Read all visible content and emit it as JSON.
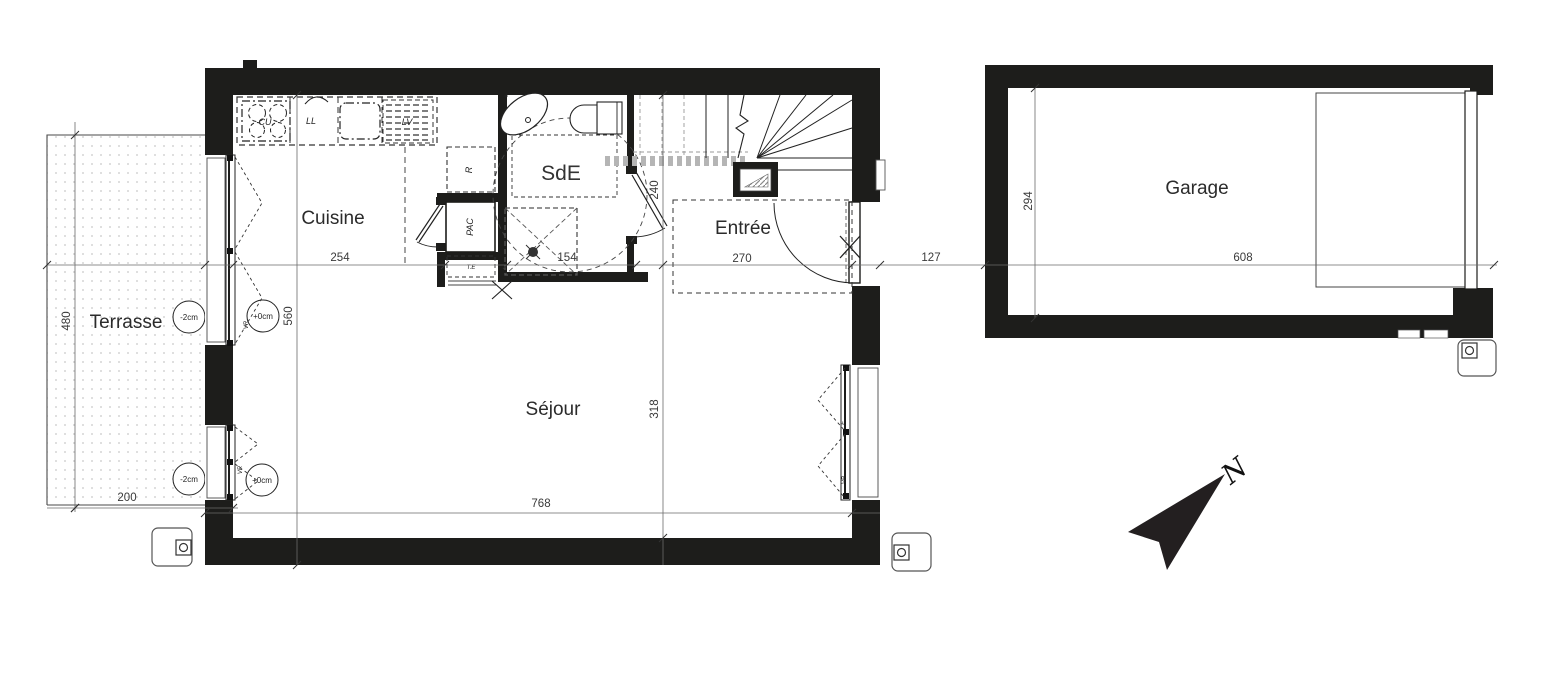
{
  "plan": {
    "rooms": {
      "terrasse": "Terrasse",
      "cuisine": "Cuisine",
      "sde": "SdE",
      "entree": "Entrée",
      "sejour": "Séjour",
      "garage": "Garage"
    },
    "dims": {
      "terrace_height": "480",
      "terrace_width": "200",
      "kitchen_width": "254",
      "bathroom_width": "154",
      "hall_depth": "240",
      "entry_width": "270",
      "house_depth": "560",
      "living_depth": "318",
      "house_width": "768",
      "gap_width": "127",
      "garage_width": "608",
      "garage_depth": "294"
    },
    "levels": {
      "terrace_upper": "-2cm",
      "terrace_lower": "-2cm",
      "interior_upper": "+0cm",
      "interior_lower": "+0cm"
    },
    "equipment": {
      "cooktop": "CU",
      "washer": "LL",
      "dishwasher": "LV",
      "storage": "R",
      "heat_pump": "PAC",
      "electrical_panel": "T.E"
    },
    "windows": {
      "left_upper_shutter": "VR",
      "left_lower_shutter": "VR",
      "right_type": "F",
      "right_shutter": "VR"
    },
    "compass": {
      "north": "N"
    },
    "colors": {
      "wall": "#1d1d1b",
      "line": "#3f3f3f",
      "dim_text": "#3a3a3a"
    }
  }
}
